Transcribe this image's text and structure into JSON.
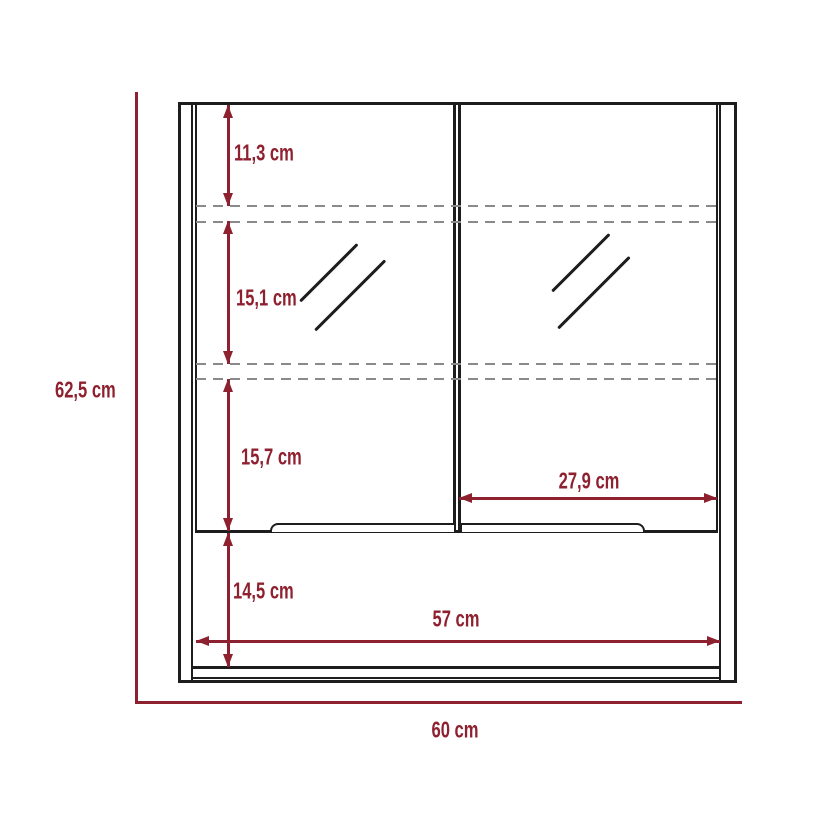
{
  "diagram": {
    "unit": "cm",
    "labels": {
      "overall_height": "62,5 cm",
      "overall_width": "60 cm",
      "interior_width": "57 cm",
      "top_section_height": "11,3 cm",
      "middle_section_height": "15,1 cm",
      "lower_section_height": "15,7 cm",
      "open_compartment_height": "14,5 cm",
      "door_interior_width": "27,9 cm"
    },
    "dimensions_cm": {
      "overall_height": 62.5,
      "overall_width": 60,
      "interior_width": 57,
      "top_section_height": 11.3,
      "middle_section_height": 15.1,
      "lower_section_height": 15.7,
      "open_compartment_height": 14.5,
      "door_interior_width": 27.9
    },
    "colors": {
      "dimension_accent": "#8E2130",
      "outline": "#1D1D1D",
      "hidden_shelf_line": "#8A8A8A",
      "background": "#FFFFFF"
    }
  }
}
